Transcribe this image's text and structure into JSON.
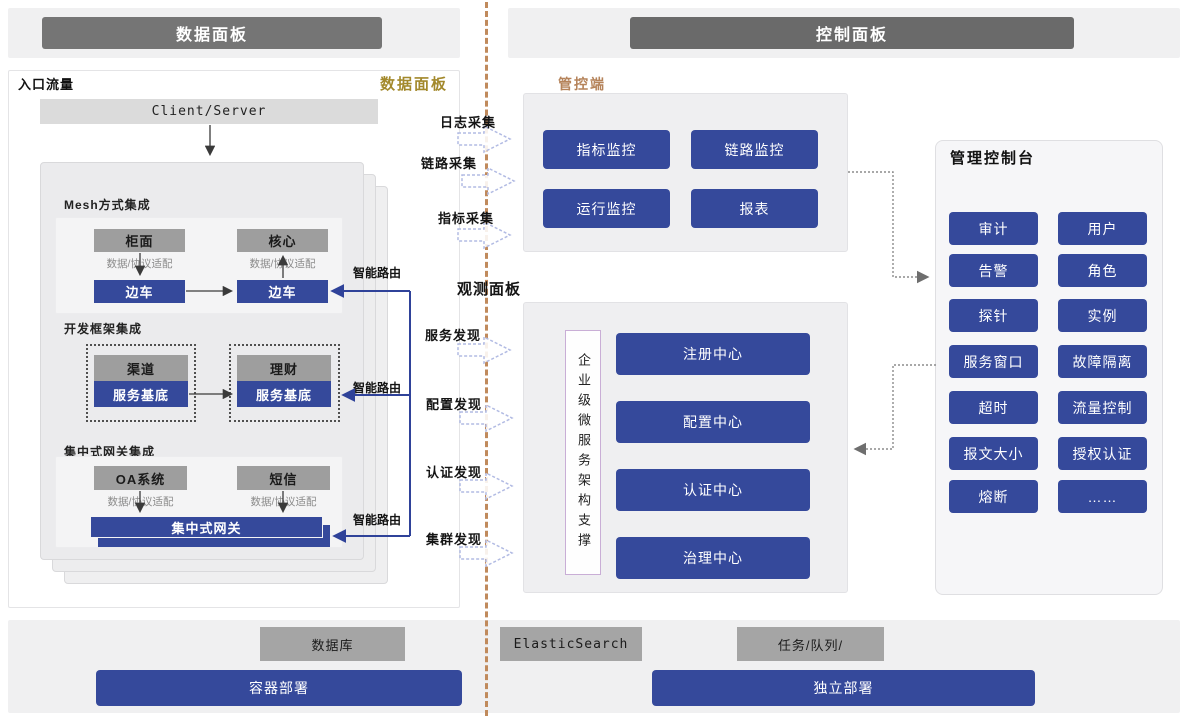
{
  "header": {
    "left": "数据面板",
    "right": "控制面板"
  },
  "data_panel": {
    "entry_label": "入口流量",
    "corner_label": "数据面板",
    "client_server": "Client/Server",
    "mesh": {
      "title": "Mesh方式集成",
      "app_left": "柜面",
      "app_right": "核心",
      "adapter": "数据/协议适配",
      "sidecar": "边车"
    },
    "framework": {
      "title": "开发框架集成",
      "app_left": "渠道",
      "app_right": "理财",
      "base": "服务基底"
    },
    "gateway": {
      "title": "集中式网关集成",
      "app_left": "OA系统",
      "app_right": "短信",
      "adapter": "数据/协议适配",
      "gateway": "集中式网关"
    },
    "smart_route": "智能路由"
  },
  "middle": {
    "collect": [
      "日志采集",
      "链路采集",
      "指标采集"
    ],
    "observe_title": "观测面板",
    "discover": [
      "服务发现",
      "配置发现",
      "认证发现",
      "集群发现"
    ]
  },
  "control_plane": {
    "label": "管控端",
    "buttons": [
      "指标监控",
      "链路监控",
      "运行监控",
      "报表"
    ]
  },
  "observe_panel": {
    "support": "企业级微服务架构支撑",
    "buttons": [
      "注册中心",
      "配置中心",
      "认证中心",
      "治理中心"
    ]
  },
  "console": {
    "title": "管理控制台",
    "buttons": [
      "审计",
      "用户",
      "告警",
      "角色",
      "探针",
      "实例",
      "服务窗口",
      "故障隔离",
      "超时",
      "流量控制",
      "报文大小",
      "授权认证",
      "熔断",
      "……"
    ]
  },
  "bottom": {
    "middleware": [
      "数据库",
      "ElasticSearch",
      "任务/队列/"
    ],
    "deploy": [
      "容器部署",
      "独立部署"
    ]
  },
  "colors": {
    "primary_blue": "#35499b",
    "header_gray_left": "#757575",
    "header_gray_right": "#6a6a6a",
    "box_gray": "#9e9e9e",
    "accent_gold": "#a3892c",
    "accent_orange": "#b5835a",
    "divider_orange": "#c08a5c"
  }
}
